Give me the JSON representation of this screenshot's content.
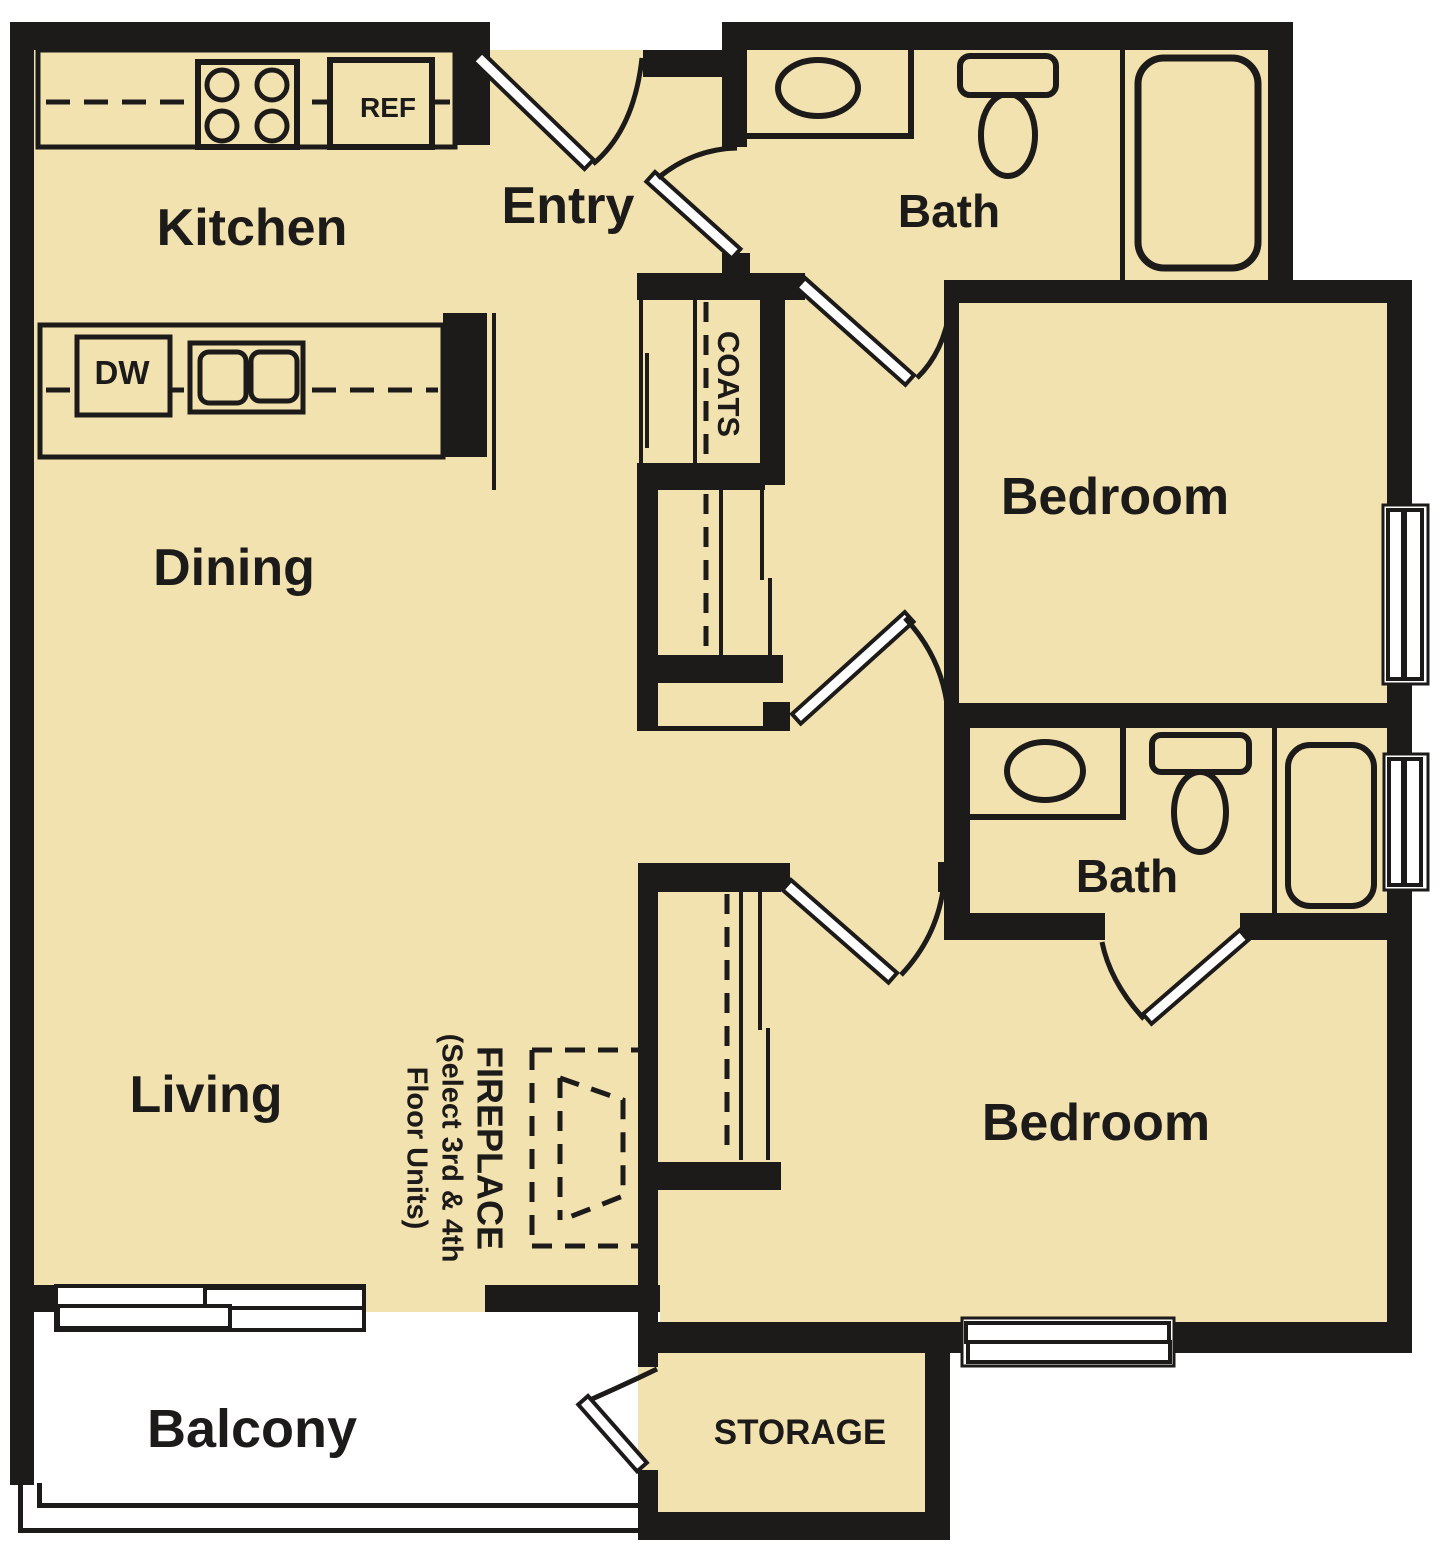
{
  "floor_plan": {
    "rooms": {
      "kitchen": "Kitchen",
      "entry": "Entry",
      "bath1": "Bath",
      "bedroom1": "Bedroom",
      "dining": "Dining",
      "coats": "COATS",
      "bath2": "Bath",
      "bedroom2": "Bedroom",
      "living": "Living",
      "balcony": "Balcony",
      "storage": "STORAGE"
    },
    "appliances": {
      "ref": "REF",
      "dw": "DW"
    },
    "fireplace": {
      "line1": "FIREPLACE",
      "line2": "(Select 3rd & 4th",
      "line3": "Floor Units)"
    },
    "colors": {
      "floor": "#F2E2B0",
      "wall": "#1D1B19",
      "outside": "#FFFFFF"
    }
  }
}
